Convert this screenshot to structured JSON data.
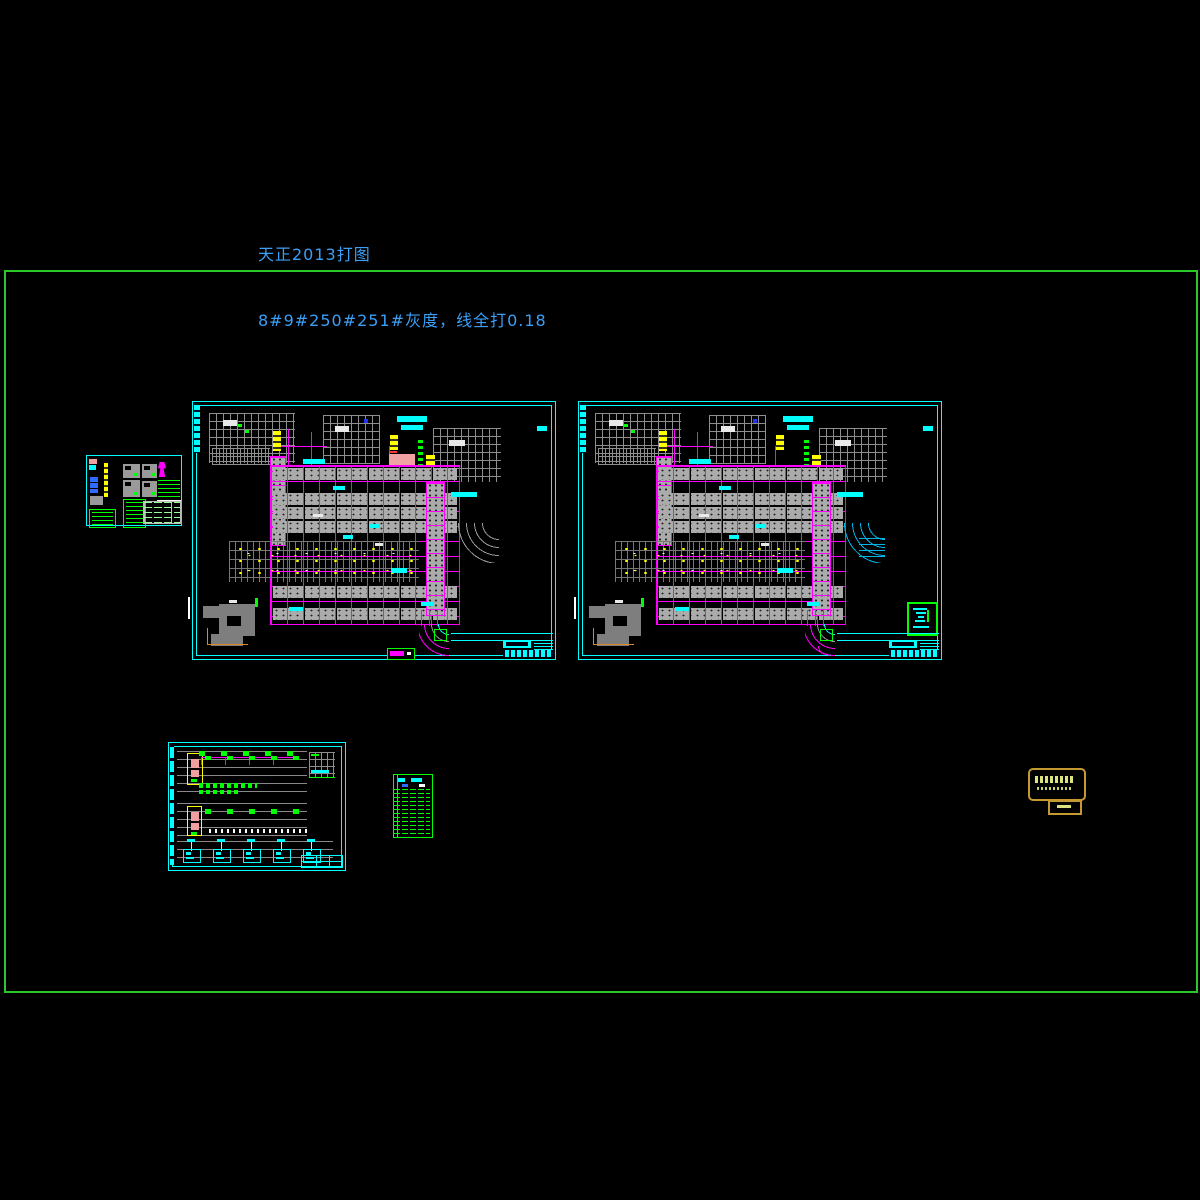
{
  "annotations": {
    "line1": "天正2013打图",
    "line2": "8#9#250#251#灰度，线全打0.18"
  },
  "palette": {
    "background": "#000000",
    "plot_border_green": "#2bc82b",
    "sheet_frame_cyan": "#00ffff",
    "column_grid_magenta": "#ff00ff",
    "beam_grid_gray": "#8e8e8e",
    "slab_gray": "#ababab",
    "highlight_yellow": "#ffff00",
    "fill_salmon": "#f0a2a2",
    "annotation_blue": "#3b9ff5",
    "legend_green": "#00ff00",
    "road_cyan": "#00b4e6",
    "stamp_border_gold": "#c49a30",
    "stamp_text_yellow": "#dde37c"
  },
  "sheets": {
    "count": 6,
    "list": [
      "detail-sheet-small",
      "floor-plan-left",
      "floor-plan-right",
      "system-diagram-sheet",
      "schedule-table",
      "seal-stamp"
    ]
  }
}
